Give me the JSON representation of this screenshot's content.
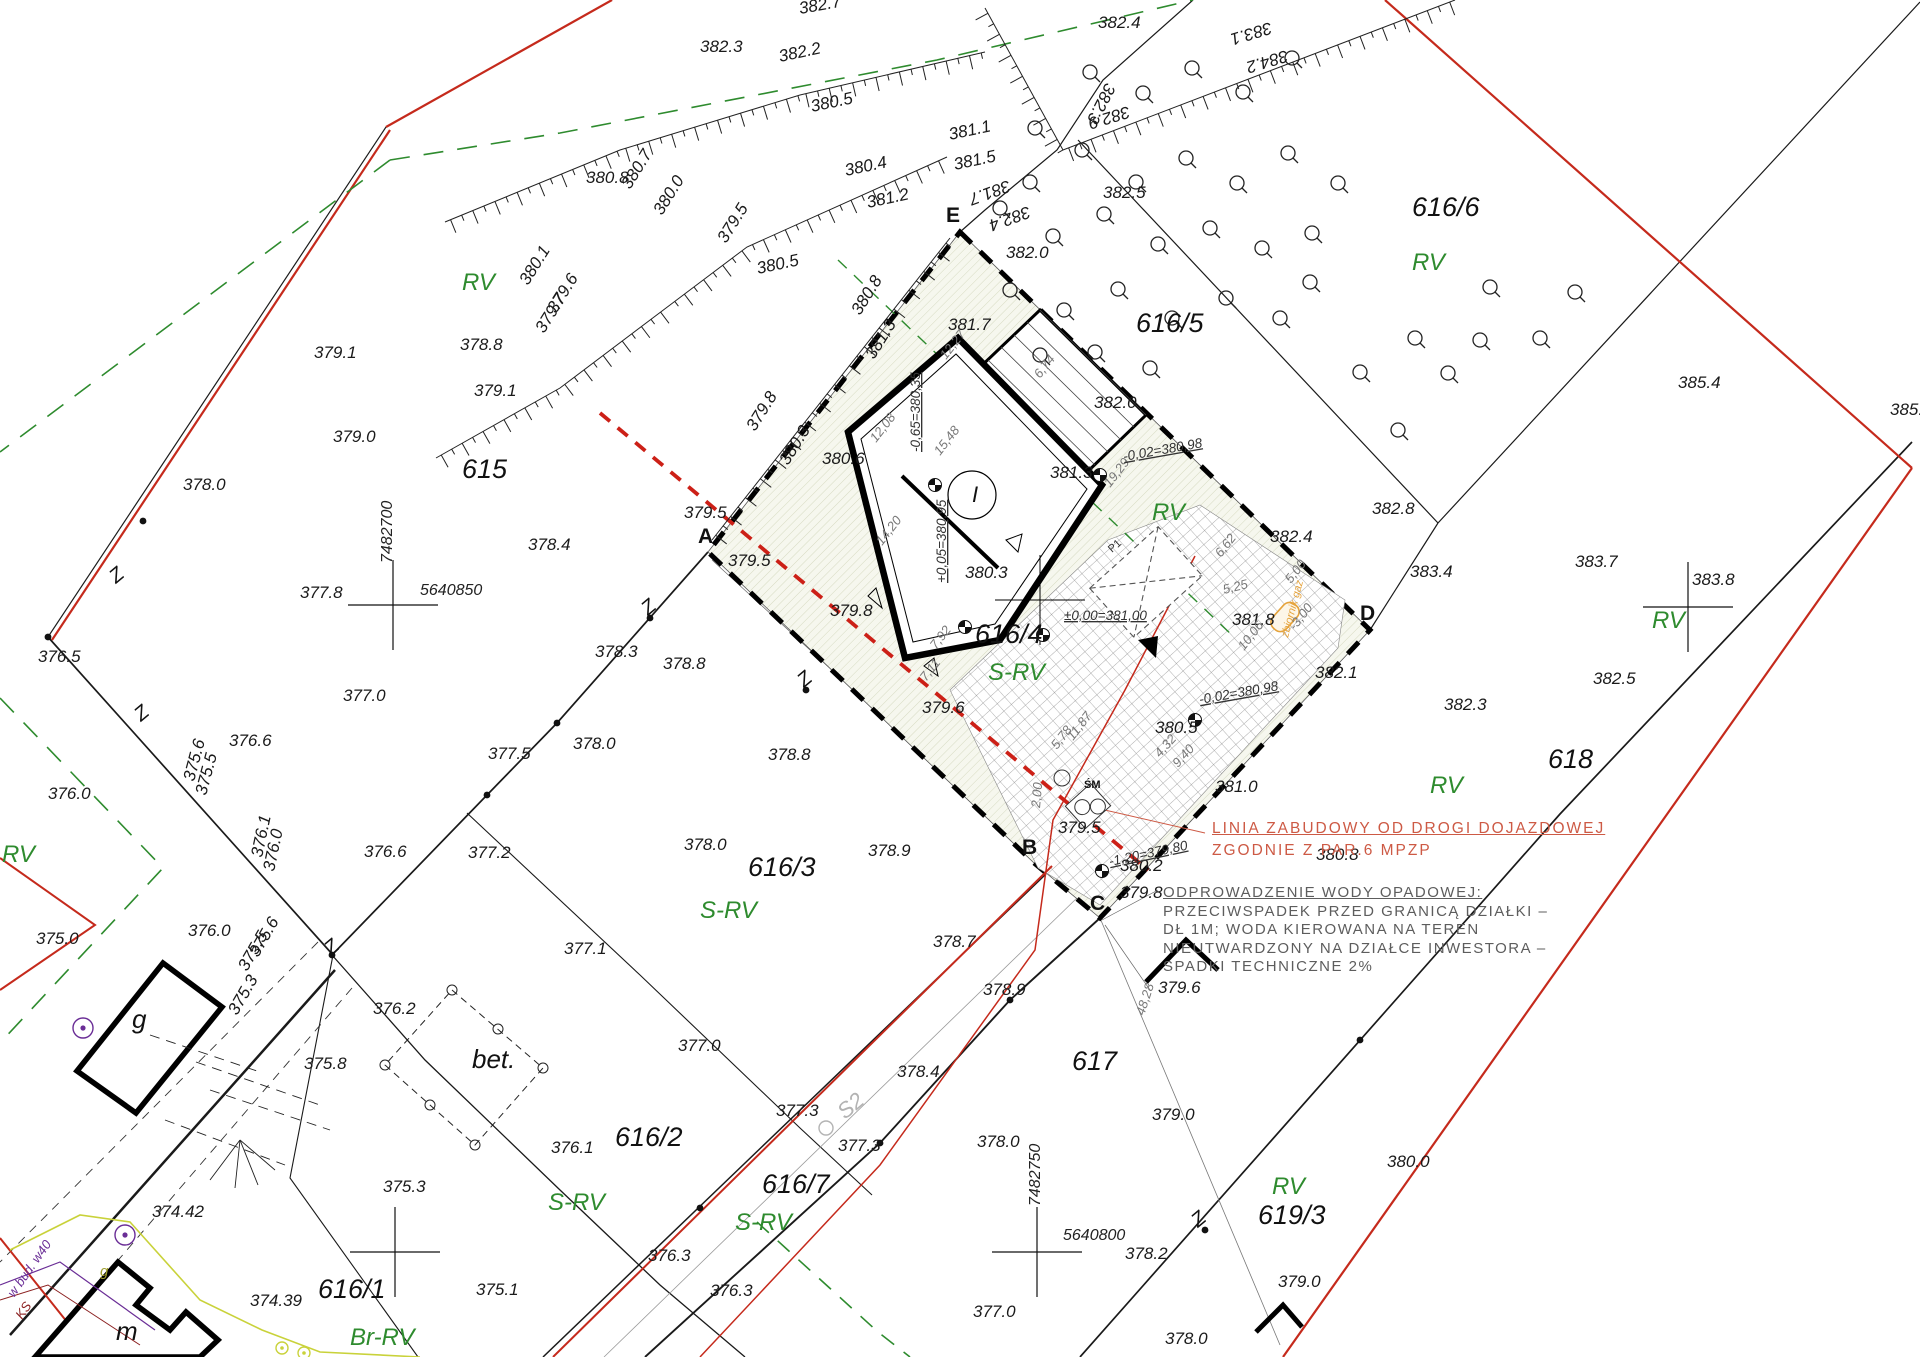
{
  "colors": {
    "red_boundary": "#c52a1c",
    "green_landuse": "#2e8b2e",
    "annotation_red": "#cd5a45",
    "annotation_gray": "#5d5d5d",
    "orange_gas": "#e5a33c",
    "purple_utility": "#6a2d96",
    "gas_line": "#c9d23a",
    "site_hatch": "#b9c29a"
  },
  "annotations": {
    "building_line_1": "LINIA ZABUDOWY OD DROGI DOJAZDOWEJ",
    "building_line_2": "ZGODNIE Z PAR.6 MPZP",
    "drainage": [
      "ODPROWADZENIE WODY OPADOWEJ:",
      "PRZECIWSPADEK PRZED GRANICĄ DZIAŁKI –",
      "DŁ 1M; WODA KIEROWANA NA TEREN",
      "NIEUTWARDZONY NA DZIAŁCE INWESTORA –",
      "SPADKI TECHNICZNE 2%"
    ]
  },
  "parcels": [
    {
      "t": "615",
      "x": 462,
      "y": 478
    },
    {
      "t": "616/1",
      "x": 318,
      "y": 1298
    },
    {
      "t": "616/2",
      "x": 615,
      "y": 1146
    },
    {
      "t": "616/3",
      "x": 748,
      "y": 876
    },
    {
      "t": "616/4",
      "x": 975,
      "y": 643
    },
    {
      "t": "616/5",
      "x": 1136,
      "y": 332
    },
    {
      "t": "616/6",
      "x": 1412,
      "y": 216
    },
    {
      "t": "616/7",
      "x": 762,
      "y": 1193
    },
    {
      "t": "617",
      "x": 1072,
      "y": 1070
    },
    {
      "t": "618",
      "x": 1548,
      "y": 768
    },
    {
      "t": "619/3",
      "x": 1258,
      "y": 1224
    }
  ],
  "landuse": [
    {
      "t": "RV",
      "x": 462,
      "y": 290
    },
    {
      "t": "RV",
      "x": 1412,
      "y": 270
    },
    {
      "t": "RV",
      "x": 1152,
      "y": 520
    },
    {
      "t": "RV",
      "x": 1430,
      "y": 793
    },
    {
      "t": "RV",
      "x": 1652,
      "y": 628
    },
    {
      "t": "RV",
      "x": 1272,
      "y": 1194
    },
    {
      "t": "RV",
      "x": 2,
      "y": 862
    },
    {
      "t": "S-RV",
      "x": 700,
      "y": 918
    },
    {
      "t": "S-RV",
      "x": 548,
      "y": 1210
    },
    {
      "t": "S-RV",
      "x": 735,
      "y": 1230
    },
    {
      "t": "S-RV",
      "x": 988,
      "y": 680
    },
    {
      "t": "Br-RV",
      "x": 350,
      "y": 1345
    }
  ],
  "corners": [
    {
      "t": "E",
      "x": 946,
      "y": 222
    },
    {
      "t": "A",
      "x": 698,
      "y": 543
    },
    {
      "t": "B",
      "x": 1022,
      "y": 854
    },
    {
      "t": "C",
      "x": 1090,
      "y": 910
    },
    {
      "t": "D",
      "x": 1360,
      "y": 620
    }
  ],
  "elevations": [
    {
      "t": "382.7",
      "x": 800,
      "y": 14,
      "r": -10
    },
    {
      "t": "382.3",
      "x": 700,
      "y": 52
    },
    {
      "t": "382.2",
      "x": 780,
      "y": 62,
      "r": -12
    },
    {
      "t": "380.5",
      "x": 812,
      "y": 112,
      "r": -12
    },
    {
      "t": "382.4",
      "x": 1098,
      "y": 28
    },
    {
      "t": "383.1",
      "x": 1270,
      "y": 22,
      "r": 163
    },
    {
      "t": "384.2",
      "x": 1286,
      "y": 50,
      "r": 163
    },
    {
      "t": "382.3",
      "x": 1106,
      "y": 82,
      "r": 117
    },
    {
      "t": "382.9",
      "x": 1128,
      "y": 106,
      "r": 163
    },
    {
      "t": "381.7",
      "x": 1008,
      "y": 180,
      "r": 160
    },
    {
      "t": "382.4",
      "x": 1028,
      "y": 206,
      "r": 160
    },
    {
      "t": "382.5",
      "x": 1103,
      "y": 198
    },
    {
      "t": "380.8",
      "x": 586,
      "y": 183
    },
    {
      "t": "380.7",
      "x": 630,
      "y": 190,
      "r": -58
    },
    {
      "t": "380.0",
      "x": 662,
      "y": 216,
      "r": -58
    },
    {
      "t": "380.4",
      "x": 846,
      "y": 176,
      "r": -12
    },
    {
      "t": "381.2",
      "x": 868,
      "y": 208,
      "r": -12
    },
    {
      "t": "381.1",
      "x": 950,
      "y": 140,
      "r": -12
    },
    {
      "t": "381.5",
      "x": 955,
      "y": 170,
      "r": -12
    },
    {
      "t": "379.5",
      "x": 726,
      "y": 244,
      "r": -58
    },
    {
      "t": "380.5",
      "x": 758,
      "y": 274,
      "r": -12
    },
    {
      "t": "382.0",
      "x": 1006,
      "y": 258
    },
    {
      "t": "381.7",
      "x": 948,
      "y": 330
    },
    {
      "t": "380.8",
      "x": 860,
      "y": 316,
      "r": -58
    },
    {
      "t": "381.3",
      "x": 874,
      "y": 360,
      "r": -58
    },
    {
      "t": "382.0",
      "x": 1094,
      "y": 408
    },
    {
      "t": "380.1",
      "x": 528,
      "y": 286,
      "r": -58
    },
    {
      "t": "379.6",
      "x": 556,
      "y": 314,
      "r": -58
    },
    {
      "t": "379.7",
      "x": 544,
      "y": 334,
      "r": -58
    },
    {
      "t": "378.8",
      "x": 460,
      "y": 350
    },
    {
      "t": "379.8",
      "x": 755,
      "y": 432,
      "r": -58
    },
    {
      "t": "380.3",
      "x": 788,
      "y": 466,
      "r": -58
    },
    {
      "t": "379.1",
      "x": 314,
      "y": 358
    },
    {
      "t": "379.1",
      "x": 474,
      "y": 396
    },
    {
      "t": "379.0",
      "x": 333,
      "y": 442
    },
    {
      "t": "378.0",
      "x": 183,
      "y": 490
    },
    {
      "t": "377.8",
      "x": 300,
      "y": 598
    },
    {
      "t": "378.4",
      "x": 528,
      "y": 550
    },
    {
      "t": "379.5",
      "x": 684,
      "y": 518
    },
    {
      "t": "379.5",
      "x": 728,
      "y": 566
    },
    {
      "t": "380.6",
      "x": 822,
      "y": 464
    },
    {
      "t": "380.3",
      "x": 965,
      "y": 578
    },
    {
      "t": "381.3",
      "x": 1050,
      "y": 478
    },
    {
      "t": "379.8",
      "x": 830,
      "y": 616
    },
    {
      "t": "379.6",
      "x": 922,
      "y": 713
    },
    {
      "t": "378.3",
      "x": 595,
      "y": 657
    },
    {
      "t": "378.8",
      "x": 663,
      "y": 669
    },
    {
      "t": "378.8",
      "x": 768,
      "y": 760
    },
    {
      "t": "378.0",
      "x": 573,
      "y": 749
    },
    {
      "t": "377.5",
      "x": 488,
      "y": 759
    },
    {
      "t": "377.0",
      "x": 343,
      "y": 701
    },
    {
      "t": "376.5",
      "x": 38,
      "y": 662
    },
    {
      "t": "376.6",
      "x": 229,
      "y": 746
    },
    {
      "t": "376.0",
      "x": 48,
      "y": 799
    },
    {
      "t": "376.0",
      "x": 188,
      "y": 936
    },
    {
      "t": "375.0",
      "x": 36,
      "y": 944
    },
    {
      "t": "376.6",
      "x": 364,
      "y": 857
    },
    {
      "t": "377.2",
      "x": 468,
      "y": 858
    },
    {
      "t": "378.0",
      "x": 684,
      "y": 850
    },
    {
      "t": "378.9",
      "x": 868,
      "y": 856
    },
    {
      "t": "377.1",
      "x": 564,
      "y": 954
    },
    {
      "t": "376.2",
      "x": 373,
      "y": 1014
    },
    {
      "t": "375.8",
      "x": 304,
      "y": 1069
    },
    {
      "t": "375.3",
      "x": 383,
      "y": 1192
    },
    {
      "t": "374.42",
      "x": 152,
      "y": 1217
    },
    {
      "t": "374.39",
      "x": 250,
      "y": 1306
    },
    {
      "t": "375.1",
      "x": 476,
      "y": 1295
    },
    {
      "t": "377.0",
      "x": 678,
      "y": 1051
    },
    {
      "t": "376.1",
      "x": 551,
      "y": 1153
    },
    {
      "t": "377.3",
      "x": 776,
      "y": 1116
    },
    {
      "t": "377.3",
      "x": 838,
      "y": 1151
    },
    {
      "t": "376.3",
      "x": 648,
      "y": 1261
    },
    {
      "t": "376.3",
      "x": 710,
      "y": 1296
    },
    {
      "t": "378.7",
      "x": 933,
      "y": 947
    },
    {
      "t": "378.9",
      "x": 983,
      "y": 995
    },
    {
      "t": "379.8",
      "x": 1120,
      "y": 898
    },
    {
      "t": "379.5",
      "x": 1058,
      "y": 833
    },
    {
      "t": "380.5",
      "x": 1155,
      "y": 733
    },
    {
      "t": "381.0",
      "x": 1215,
      "y": 792
    },
    {
      "t": "380.8",
      "x": 1316,
      "y": 860
    },
    {
      "t": "381.8",
      "x": 1232,
      "y": 625
    },
    {
      "t": "382.1",
      "x": 1315,
      "y": 678
    },
    {
      "t": "382.4",
      "x": 1270,
      "y": 542
    },
    {
      "t": "383.4",
      "x": 1410,
      "y": 577
    },
    {
      "t": "382.8",
      "x": 1372,
      "y": 514
    },
    {
      "t": "383.7",
      "x": 1575,
      "y": 567
    },
    {
      "t": "385.4",
      "x": 1678,
      "y": 388
    },
    {
      "t": "385.7",
      "x": 1890,
      "y": 415
    },
    {
      "t": "382.3",
      "x": 1444,
      "y": 710
    },
    {
      "t": "383.8",
      "x": 1692,
      "y": 585
    },
    {
      "t": "382.5",
      "x": 1593,
      "y": 684
    },
    {
      "t": "379.6",
      "x": 1158,
      "y": 993
    },
    {
      "t": "379.0",
      "x": 1152,
      "y": 1120
    },
    {
      "t": "378.0",
      "x": 977,
      "y": 1147
    },
    {
      "t": "378.4",
      "x": 897,
      "y": 1077
    },
    {
      "t": "379.0",
      "x": 1278,
      "y": 1287
    },
    {
      "t": "378.2",
      "x": 1125,
      "y": 1259
    },
    {
      "t": "377.0",
      "x": 973,
      "y": 1317
    },
    {
      "t": "378.0",
      "x": 1165,
      "y": 1344
    },
    {
      "t": "380.2",
      "x": 1120,
      "y": 871
    },
    {
      "t": "380.0",
      "x": 1387,
      "y": 1167
    },
    {
      "t": "376.1",
      "x": 262,
      "y": 858,
      "r": -78
    },
    {
      "t": "376.0",
      "x": 274,
      "y": 872,
      "r": -78
    },
    {
      "t": "375.6",
      "x": 194,
      "y": 782,
      "r": -75
    },
    {
      "t": "375.5",
      "x": 206,
      "y": 796,
      "r": -75
    },
    {
      "t": "375.6",
      "x": 258,
      "y": 958,
      "r": -60
    },
    {
      "t": "375.5",
      "x": 247,
      "y": 972,
      "r": -60
    },
    {
      "t": "375.3",
      "x": 237,
      "y": 1016,
      "r": -60
    }
  ],
  "dims": [
    {
      "t": "12,27",
      "x": 946,
      "y": 360,
      "r": -52
    },
    {
      "t": "12,08",
      "x": 876,
      "y": 443,
      "r": -52
    },
    {
      "t": "15,48",
      "x": 940,
      "y": 456,
      "r": -52
    },
    {
      "t": "14,20",
      "x": 882,
      "y": 546,
      "r": -52
    },
    {
      "t": "6,74",
      "x": 1040,
      "y": 379,
      "r": -52
    },
    {
      "t": "19,29",
      "x": 1110,
      "y": 488,
      "r": -52
    },
    {
      "t": "6,62",
      "x": 1221,
      "y": 558,
      "r": -52
    },
    {
      "t": "5,25",
      "x": 1224,
      "y": 594,
      "r": -14
    },
    {
      "t": "5,00",
      "x": 1291,
      "y": 584,
      "r": -52
    },
    {
      "t": "-3,00",
      "x": 1295,
      "y": 631,
      "r": -52
    },
    {
      "t": "10,06",
      "x": 1244,
      "y": 651,
      "r": -52
    },
    {
      "t": "11,87",
      "x": 1073,
      "y": 741,
      "r": -52
    },
    {
      "t": "5,78",
      "x": 1057,
      "y": 750,
      "r": -52
    },
    {
      "t": "7,92",
      "x": 936,
      "y": 650,
      "r": -52
    },
    {
      "t": "7,11",
      "x": 926,
      "y": 682,
      "r": -52
    },
    {
      "t": "2,00",
      "x": 1040,
      "y": 808,
      "r": -85
    },
    {
      "t": "4,32",
      "x": 1160,
      "y": 758,
      "r": -48
    },
    {
      "t": "9,40",
      "x": 1178,
      "y": 768,
      "r": -48
    },
    {
      "t": "48,28",
      "x": 1144,
      "y": 1016,
      "r": -72
    }
  ],
  "levels": [
    {
      "t": "±0,00=381,00",
      "x": 1064,
      "y": 620
    },
    {
      "t": "-0,65=380,35",
      "x": 920,
      "y": 452,
      "r": -90
    },
    {
      "t": "+0,05=380,95",
      "x": 946,
      "y": 583,
      "r": -90
    },
    {
      "t": "-0,02=380,98",
      "x": 1124,
      "y": 461,
      "r": -10
    },
    {
      "t": "-0,02=380,98",
      "x": 1200,
      "y": 704,
      "r": -10
    },
    {
      "t": "-1,20=379,80",
      "x": 1110,
      "y": 866,
      "r": -12
    }
  ],
  "coords": [
    {
      "t": "7482700",
      "x": 392,
      "y": 563,
      "r": -90
    },
    {
      "t": "5640850",
      "x": 420,
      "y": 595
    },
    {
      "t": "7482750",
      "x": 1040,
      "y": 1206,
      "r": -90
    },
    {
      "t": "5640800",
      "x": 1063,
      "y": 1240
    }
  ],
  "misc": [
    {
      "t": "bet.",
      "x": 472,
      "y": 1068,
      "c": "lbl-bet",
      "n": "concrete-area-label"
    },
    {
      "t": "g",
      "x": 132,
      "y": 1028,
      "c": "lbl-bld",
      "n": "outbuilding-g-label"
    },
    {
      "t": "m",
      "x": 116,
      "y": 1340,
      "c": "lbl-bld",
      "n": "building-m-label"
    },
    {
      "t": "g",
      "x": 100,
      "y": 1276,
      "c": "lbl-gas",
      "n": "gas-line-label"
    },
    {
      "t": "ŚM",
      "x": 1084,
      "y": 788,
      "c": "lbl-sm",
      "n": "waste-bin-label"
    },
    {
      "t": "I",
      "x": 972,
      "y": 502,
      "c": "lbl-circleI",
      "n": "building-number-label"
    },
    {
      "t": "P1",
      "x": 1112,
      "y": 553,
      "r": -42,
      "c": "lbl-tiny",
      "n": "porch-label"
    },
    {
      "t": "zbiornik gaz",
      "x": 1288,
      "y": 638,
      "r": -75,
      "c": "lbl-orange",
      "n": "gas-tank-label"
    },
    {
      "t": "w bud. w40",
      "x": 14,
      "y": 1298,
      "r": -55,
      "c": "lbl-purple",
      "n": "utility-note-label"
    },
    {
      "t": "KS",
      "x": 22,
      "y": 1320,
      "r": -55,
      "c": "lbl-ks",
      "n": "sewer-label"
    },
    {
      "t": "S2",
      "x": 845,
      "y": 1120,
      "r": -40,
      "c": "lbl-s2",
      "n": "road-symbol-label"
    }
  ],
  "zmarks": [
    {
      "x": 648,
      "y": 616
    },
    {
      "x": 804,
      "y": 688
    },
    {
      "x": 331,
      "y": 956
    },
    {
      "x": 141,
      "y": 722
    },
    {
      "x": 116,
      "y": 584
    },
    {
      "x": 1198,
      "y": 1228
    }
  ],
  "crosses": [
    {
      "x": 393,
      "y": 605
    },
    {
      "x": 1688,
      "y": 607
    },
    {
      "x": 1037,
      "y": 1252
    },
    {
      "x": 395,
      "y": 1252
    }
  ],
  "trees": [
    {
      "x": 1035,
      "y": 128
    },
    {
      "x": 1090,
      "y": 72
    },
    {
      "x": 1143,
      "y": 93
    },
    {
      "x": 1192,
      "y": 68
    },
    {
      "x": 1243,
      "y": 92
    },
    {
      "x": 1292,
      "y": 58
    },
    {
      "x": 1030,
      "y": 182
    },
    {
      "x": 1082,
      "y": 150
    },
    {
      "x": 1136,
      "y": 182
    },
    {
      "x": 1186,
      "y": 158
    },
    {
      "x": 1237,
      "y": 183
    },
    {
      "x": 1288,
      "y": 153
    },
    {
      "x": 1338,
      "y": 183
    },
    {
      "x": 1000,
      "y": 208
    },
    {
      "x": 1053,
      "y": 236
    },
    {
      "x": 1104,
      "y": 214
    },
    {
      "x": 1158,
      "y": 244
    },
    {
      "x": 1210,
      "y": 228
    },
    {
      "x": 1262,
      "y": 248
    },
    {
      "x": 1312,
      "y": 233
    },
    {
      "x": 1010,
      "y": 290
    },
    {
      "x": 1064,
      "y": 310
    },
    {
      "x": 1118,
      "y": 289
    },
    {
      "x": 1172,
      "y": 318
    },
    {
      "x": 1226,
      "y": 298
    },
    {
      "x": 1280,
      "y": 318
    },
    {
      "x": 1040,
      "y": 355
    },
    {
      "x": 1095,
      "y": 352
    },
    {
      "x": 1150,
      "y": 368
    },
    {
      "x": 1310,
      "y": 282
    },
    {
      "x": 1360,
      "y": 372
    },
    {
      "x": 1415,
      "y": 338
    },
    {
      "x": 1480,
      "y": 340
    },
    {
      "x": 1540,
      "y": 338
    },
    {
      "x": 1490,
      "y": 287
    },
    {
      "x": 1575,
      "y": 292
    },
    {
      "x": 1398,
      "y": 430
    },
    {
      "x": 1448,
      "y": 373
    }
  ],
  "wells": [
    {
      "x": 83,
      "y": 1028
    },
    {
      "x": 125,
      "y": 1235
    }
  ],
  "gas_points": [
    {
      "x": 282,
      "y": 1348
    },
    {
      "x": 304,
      "y": 1353
    }
  ],
  "level_markers": [
    {
      "x": 935,
      "y": 485
    },
    {
      "x": 1100,
      "y": 475
    },
    {
      "x": 965,
      "y": 627
    },
    {
      "x": 1043,
      "y": 635
    },
    {
      "x": 1102,
      "y": 871
    },
    {
      "x": 1195,
      "y": 720
    }
  ],
  "boundary_dots": [
    {
      "x": 143,
      "y": 521
    },
    {
      "x": 48,
      "y": 637
    },
    {
      "x": 557,
      "y": 723
    },
    {
      "x": 487,
      "y": 795
    },
    {
      "x": 332,
      "y": 955
    },
    {
      "x": 650,
      "y": 618
    },
    {
      "x": 806,
      "y": 690
    },
    {
      "x": 880,
      "y": 1143
    },
    {
      "x": 1010,
      "y": 1000
    },
    {
      "x": 1205,
      "y": 1230
    },
    {
      "x": 1360,
      "y": 1040
    },
    {
      "x": 700,
      "y": 1208
    }
  ]
}
